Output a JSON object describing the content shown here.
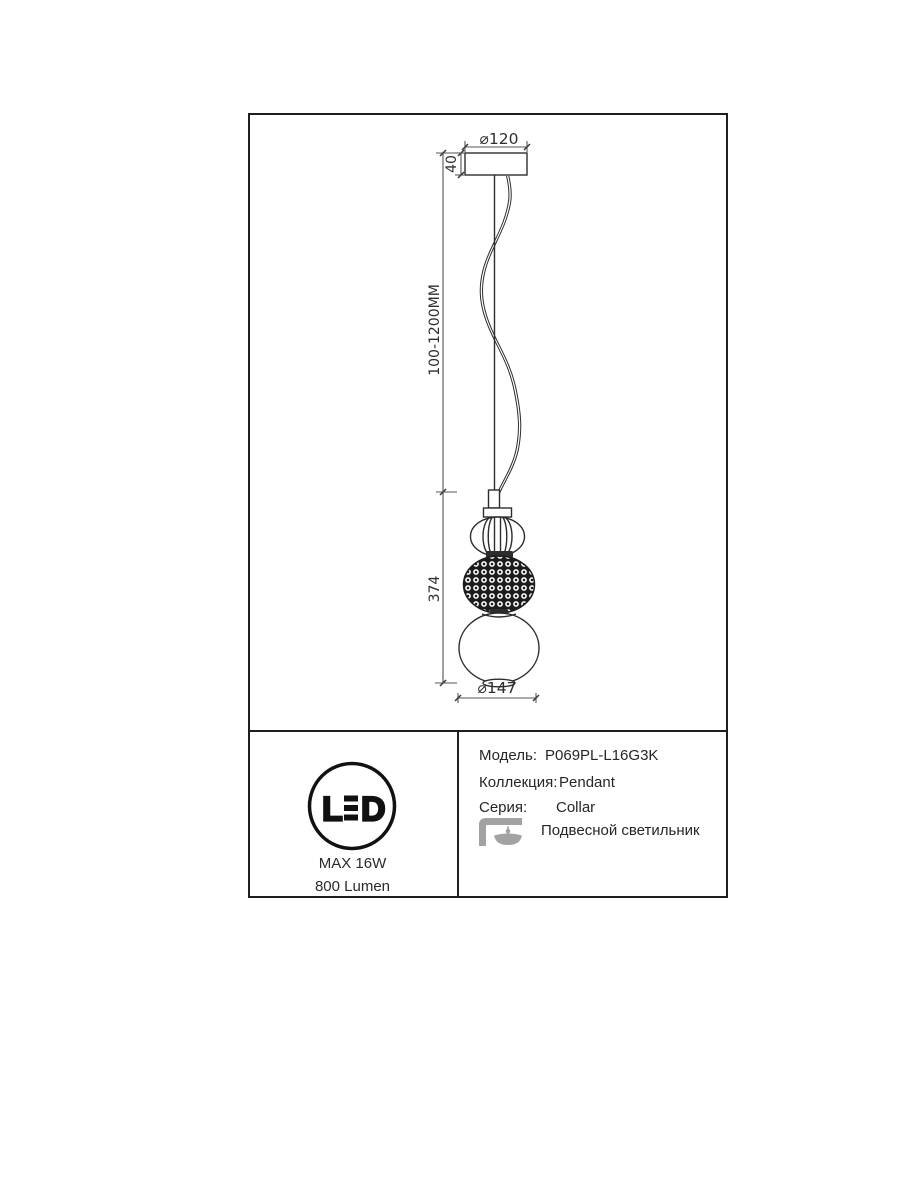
{
  "colors": {
    "background": "#ffffff",
    "line": "#2d2d2d",
    "dimension_line": "#555555",
    "border": "#1f1f1f",
    "icon_gray": "#a2a2a2"
  },
  "drawing": {
    "dim_canopy_diameter": "⌀120",
    "dim_canopy_height": "40",
    "dim_suspension_length": "100-1200MM",
    "dim_fixture_height": "374",
    "dim_globe_diameter": "⌀147"
  },
  "spec": {
    "led_badge": {
      "letter_l": "L",
      "letter_d": "D"
    },
    "max_power": "MAX 16W",
    "luminous_flux": "800 Lumen",
    "rows": [
      {
        "label": "Модель:",
        "value": "P069PL-L16G3K"
      },
      {
        "label": "Коллекция:",
        "value": "Pendant"
      },
      {
        "label": "Серия:",
        "value": "Collar"
      }
    ],
    "product_type": "Подвесной светильник",
    "icons": {
      "pendant_lamp": "pendant-lamp-icon"
    }
  }
}
